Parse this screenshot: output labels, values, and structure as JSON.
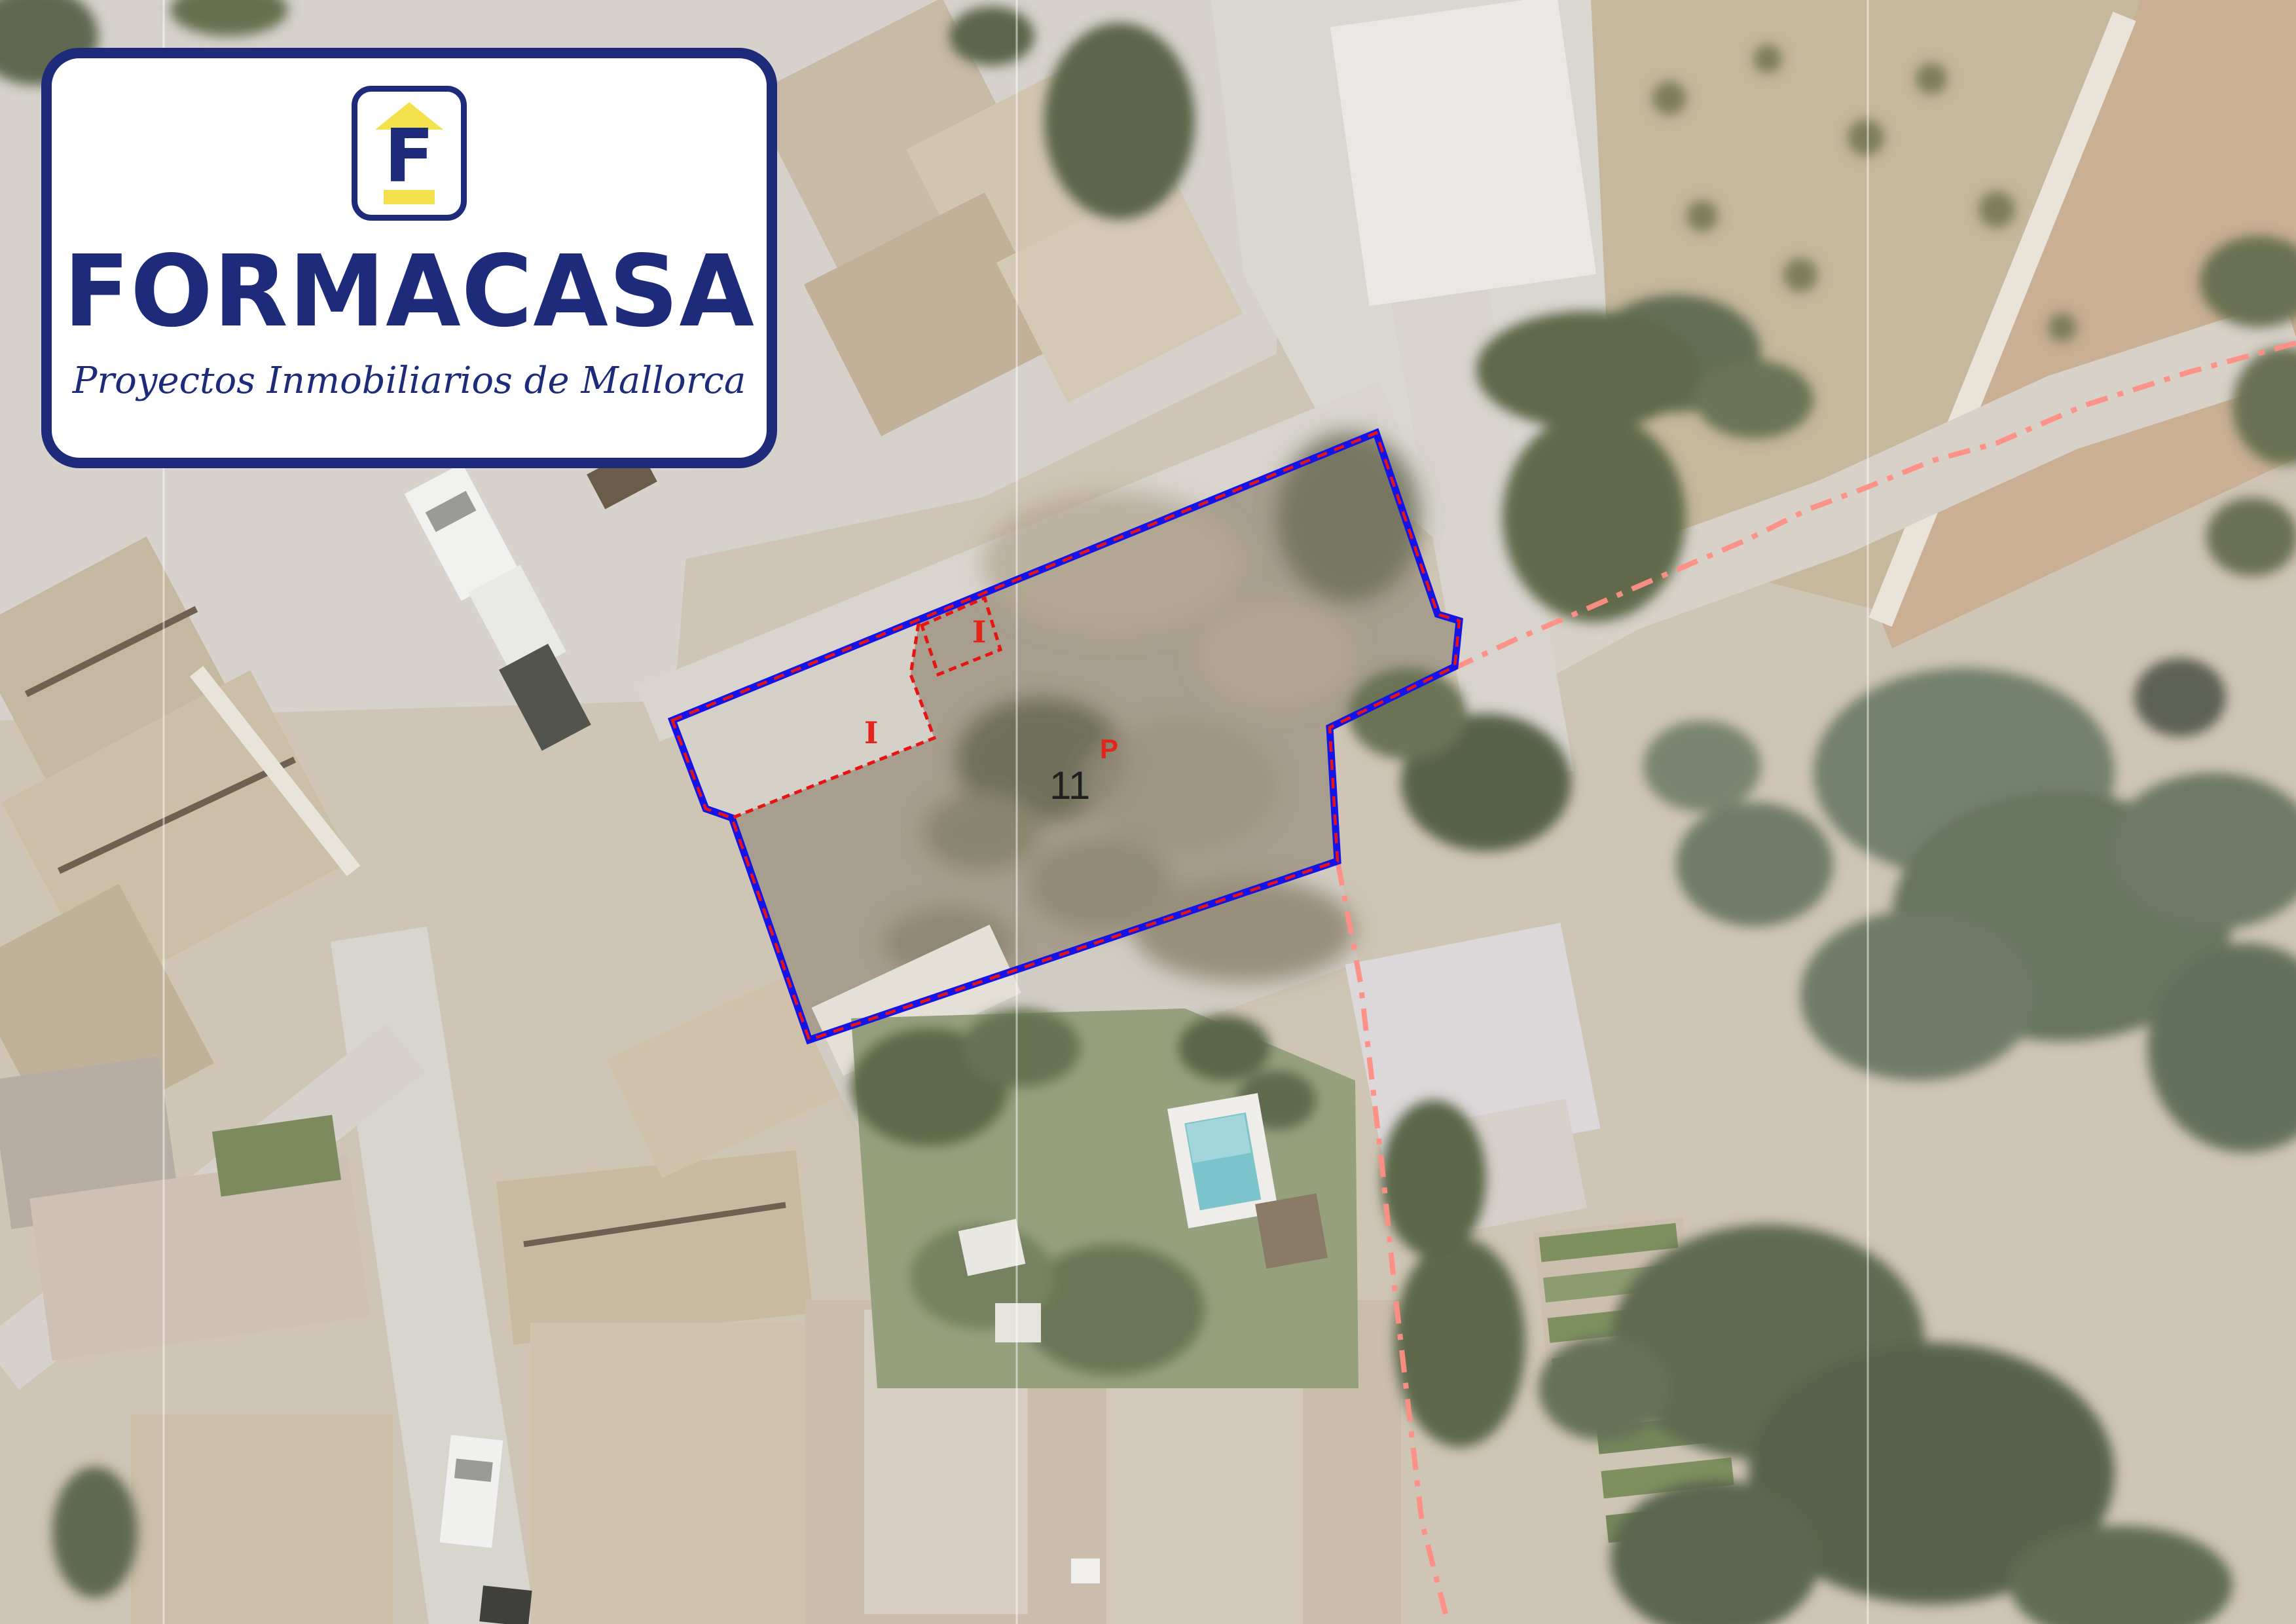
{
  "logo": {
    "brand": "FORMACASA",
    "tagline": "Proyectos Inmobiliarios de Mallorca",
    "emblem_letter": "F"
  },
  "overlay": {
    "parcel_label": "11",
    "p_label": "P",
    "i_label_small_rect": "I",
    "i_label_inner_area": "I",
    "parcel_points": "1027,1100 2102,661 2196,938 2229,948 2222,1018 2031,1111 2043,1315 1236,1588 1118,1249 1078,1235",
    "subparcel_points": "1408,955 1504,913 1528,992 1433,1030",
    "inner_line_d": "M 1403 952 L 1391 1030 L 1427 1127 L 1118 1249",
    "municipal_boundary_d": "M 3507 524 L 3344 568 L 3184 619 L 3049 677 L 2953 703 L 2847 746 L 2764 777 L 2669 824 L 2510 892 L 2400 940 L 2318 975 L 2224 1019 L 2031 1111 L 2043 1315 L 2078 1500 L 2111 1781 L 2131 1975 L 2152 2156 L 2172 2325 L 2212 2480",
    "colors": {
      "parcel-blue": "#1414e8",
      "cadastral-red": "#e81414",
      "boundary-salmon": "#ff8e85",
      "label-black": "#1f1f1d",
      "label-red": "#e4231b",
      "brand-navy": "#1e2b7a",
      "brand-yellow": "#f2e14c"
    }
  }
}
